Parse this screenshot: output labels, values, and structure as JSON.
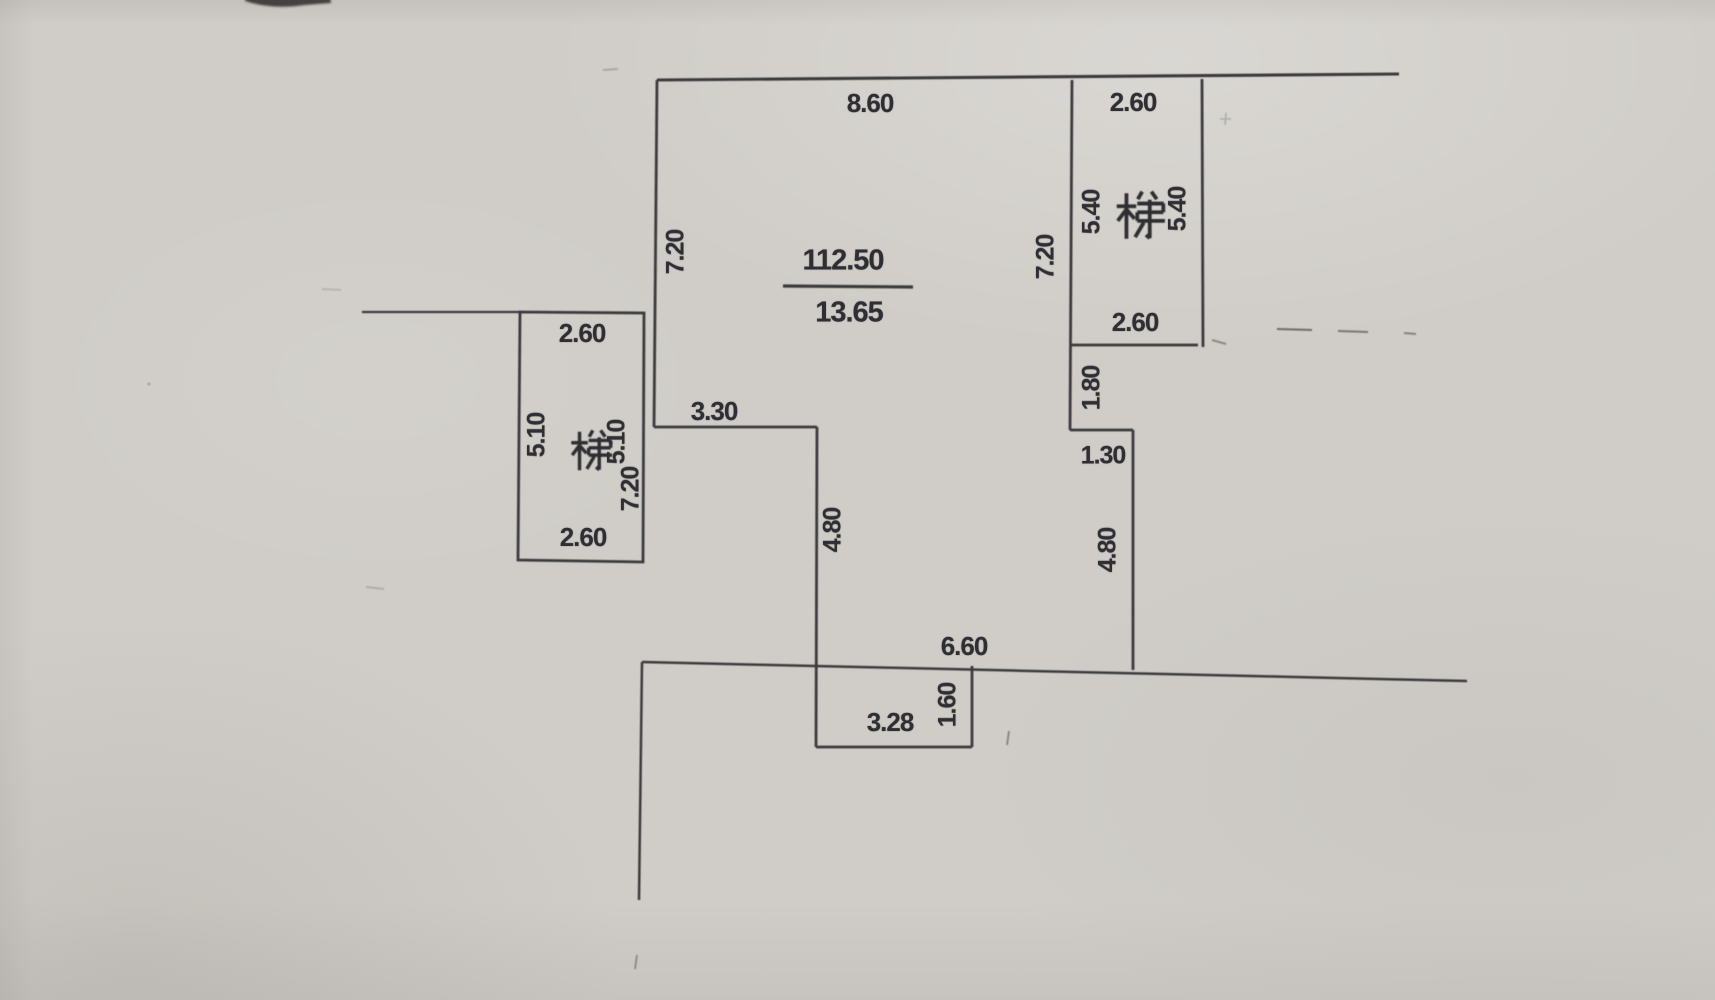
{
  "paper": {
    "color": "#d0cdc8",
    "ink_color": "#303033"
  },
  "plan": {
    "main_unit": {
      "top_width": "8.60",
      "left_height": "7.20",
      "right_height": "7.20",
      "area": {
        "numerator": "112.50",
        "denominator": "13.65"
      },
      "step": {
        "width": "3.30",
        "height": "4.80"
      }
    },
    "left_stair": {
      "char": "梯",
      "top_width": "2.60",
      "inner_height": "5.10",
      "outer_height": "5.10",
      "wall_height": "7.20",
      "bottom_width": "2.60"
    },
    "right_stair": {
      "char": "梯",
      "top_width": "2.60",
      "left_height": "5.40",
      "right_height": "5.40",
      "bottom_width": "2.60"
    },
    "right_side": {
      "drop_height": "1.80",
      "step_width": "1.30",
      "lower_height": "4.80"
    },
    "bottom": {
      "width": "6.60",
      "notch_width": "3.28",
      "notch_height": "1.60"
    }
  }
}
